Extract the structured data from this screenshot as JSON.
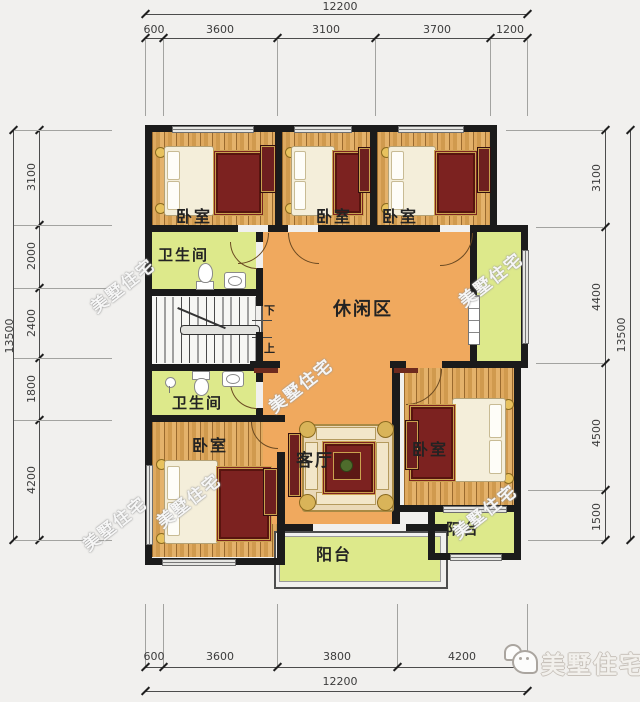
{
  "colors": {
    "background": "#f1f0ee",
    "wall": "#1b1b1b",
    "wood_floor": "#dca75c",
    "leisure_floor_orange": "#f0a95e",
    "wet_area_green": "#dde98b",
    "furniture_red": "#7c2220",
    "ornate_gold": "#caa24f"
  },
  "dims": {
    "top": {
      "total": "12200",
      "segs": [
        "600",
        "3600",
        "3100",
        "3700",
        "1200"
      ]
    },
    "bottom": {
      "total": "12200",
      "segs": [
        "600",
        "3600",
        "3800",
        "4200"
      ]
    },
    "left": {
      "total": "13500",
      "segs": [
        "3100",
        "2000",
        "2400",
        "1800",
        "4200"
      ]
    },
    "right": {
      "total": "13500",
      "segs": [
        "3100",
        "4400",
        "4500",
        "1500"
      ]
    }
  },
  "rooms": {
    "bedroom": "卧室",
    "bathroom": "卫生间",
    "leisure": "休闲区",
    "living": "客厅",
    "balcony": "阳台"
  },
  "stairs": {
    "down": "下",
    "up": "上"
  },
  "watermark": "美墅住宅",
  "logo": {
    "text": "美墅住宅",
    "icon": "wechat-chat-bubbles"
  }
}
